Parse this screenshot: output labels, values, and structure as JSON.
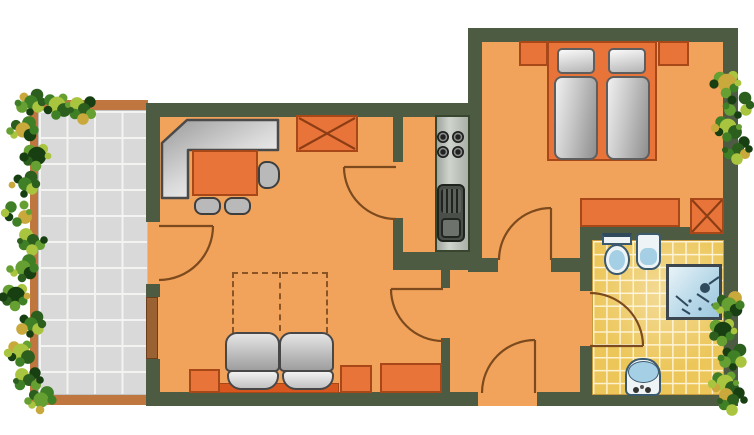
{
  "palette": {
    "background": "#ffffff",
    "wall": "#4d5b43",
    "floor": "#f1a35c",
    "furniture_orange": "#e8743a",
    "furniture_border": "#a84818",
    "sofa_base_orange": "#d8571f",
    "balcony_frame": "#c0763f",
    "balcony_tile": "#d9d9d9",
    "tile_grout": "#f3f3f1",
    "bath_tile": "#ecc659",
    "bath_grout": "#fdf2cf",
    "window_brown": "#9a6233",
    "counter_gray": "#b4bab2",
    "appliance_dark": "#4a4f4a",
    "fixture_white": "#eef4f6",
    "fixture_blue": "#a5cfe4",
    "fixture_blue_dark": "#2e4a5c",
    "shower_blue": "#b9d9e9",
    "door_stroke": "#7c4a1d",
    "dash_stroke": "#8a5424",
    "x_mark": "#8d3d14",
    "plant_greens": [
      "#173f12",
      "#2c5e1e",
      "#3f7f26",
      "#66a032",
      "#a9c43f"
    ],
    "plant_fleck": "#c9a93c"
  },
  "semantics": {
    "rooms": {
      "balcony": "balcony",
      "living": "living-room",
      "kitchen": "kitchen",
      "hall": "entrance-hall",
      "bedroom": "bedroom",
      "bathroom": "bathroom"
    },
    "icons": [
      "plant-icon",
      "door-swing-icon",
      "window-icon",
      "wardrobe-x-icon",
      "corner-bench-icon",
      "dining-table-icon",
      "chair-icon",
      "sofa-bed-icon",
      "fold-out-bed-outline-icon",
      "side-table-icon",
      "stove-icon",
      "kitchen-sink-icon",
      "double-bed-icon",
      "pillow-icon",
      "nightstand-icon",
      "dresser-icon",
      "toilet-icon",
      "bidet-icon",
      "shower-icon",
      "washbasin-icon",
      "balcony-tiles-icon",
      "bathroom-tiles-icon"
    ]
  }
}
